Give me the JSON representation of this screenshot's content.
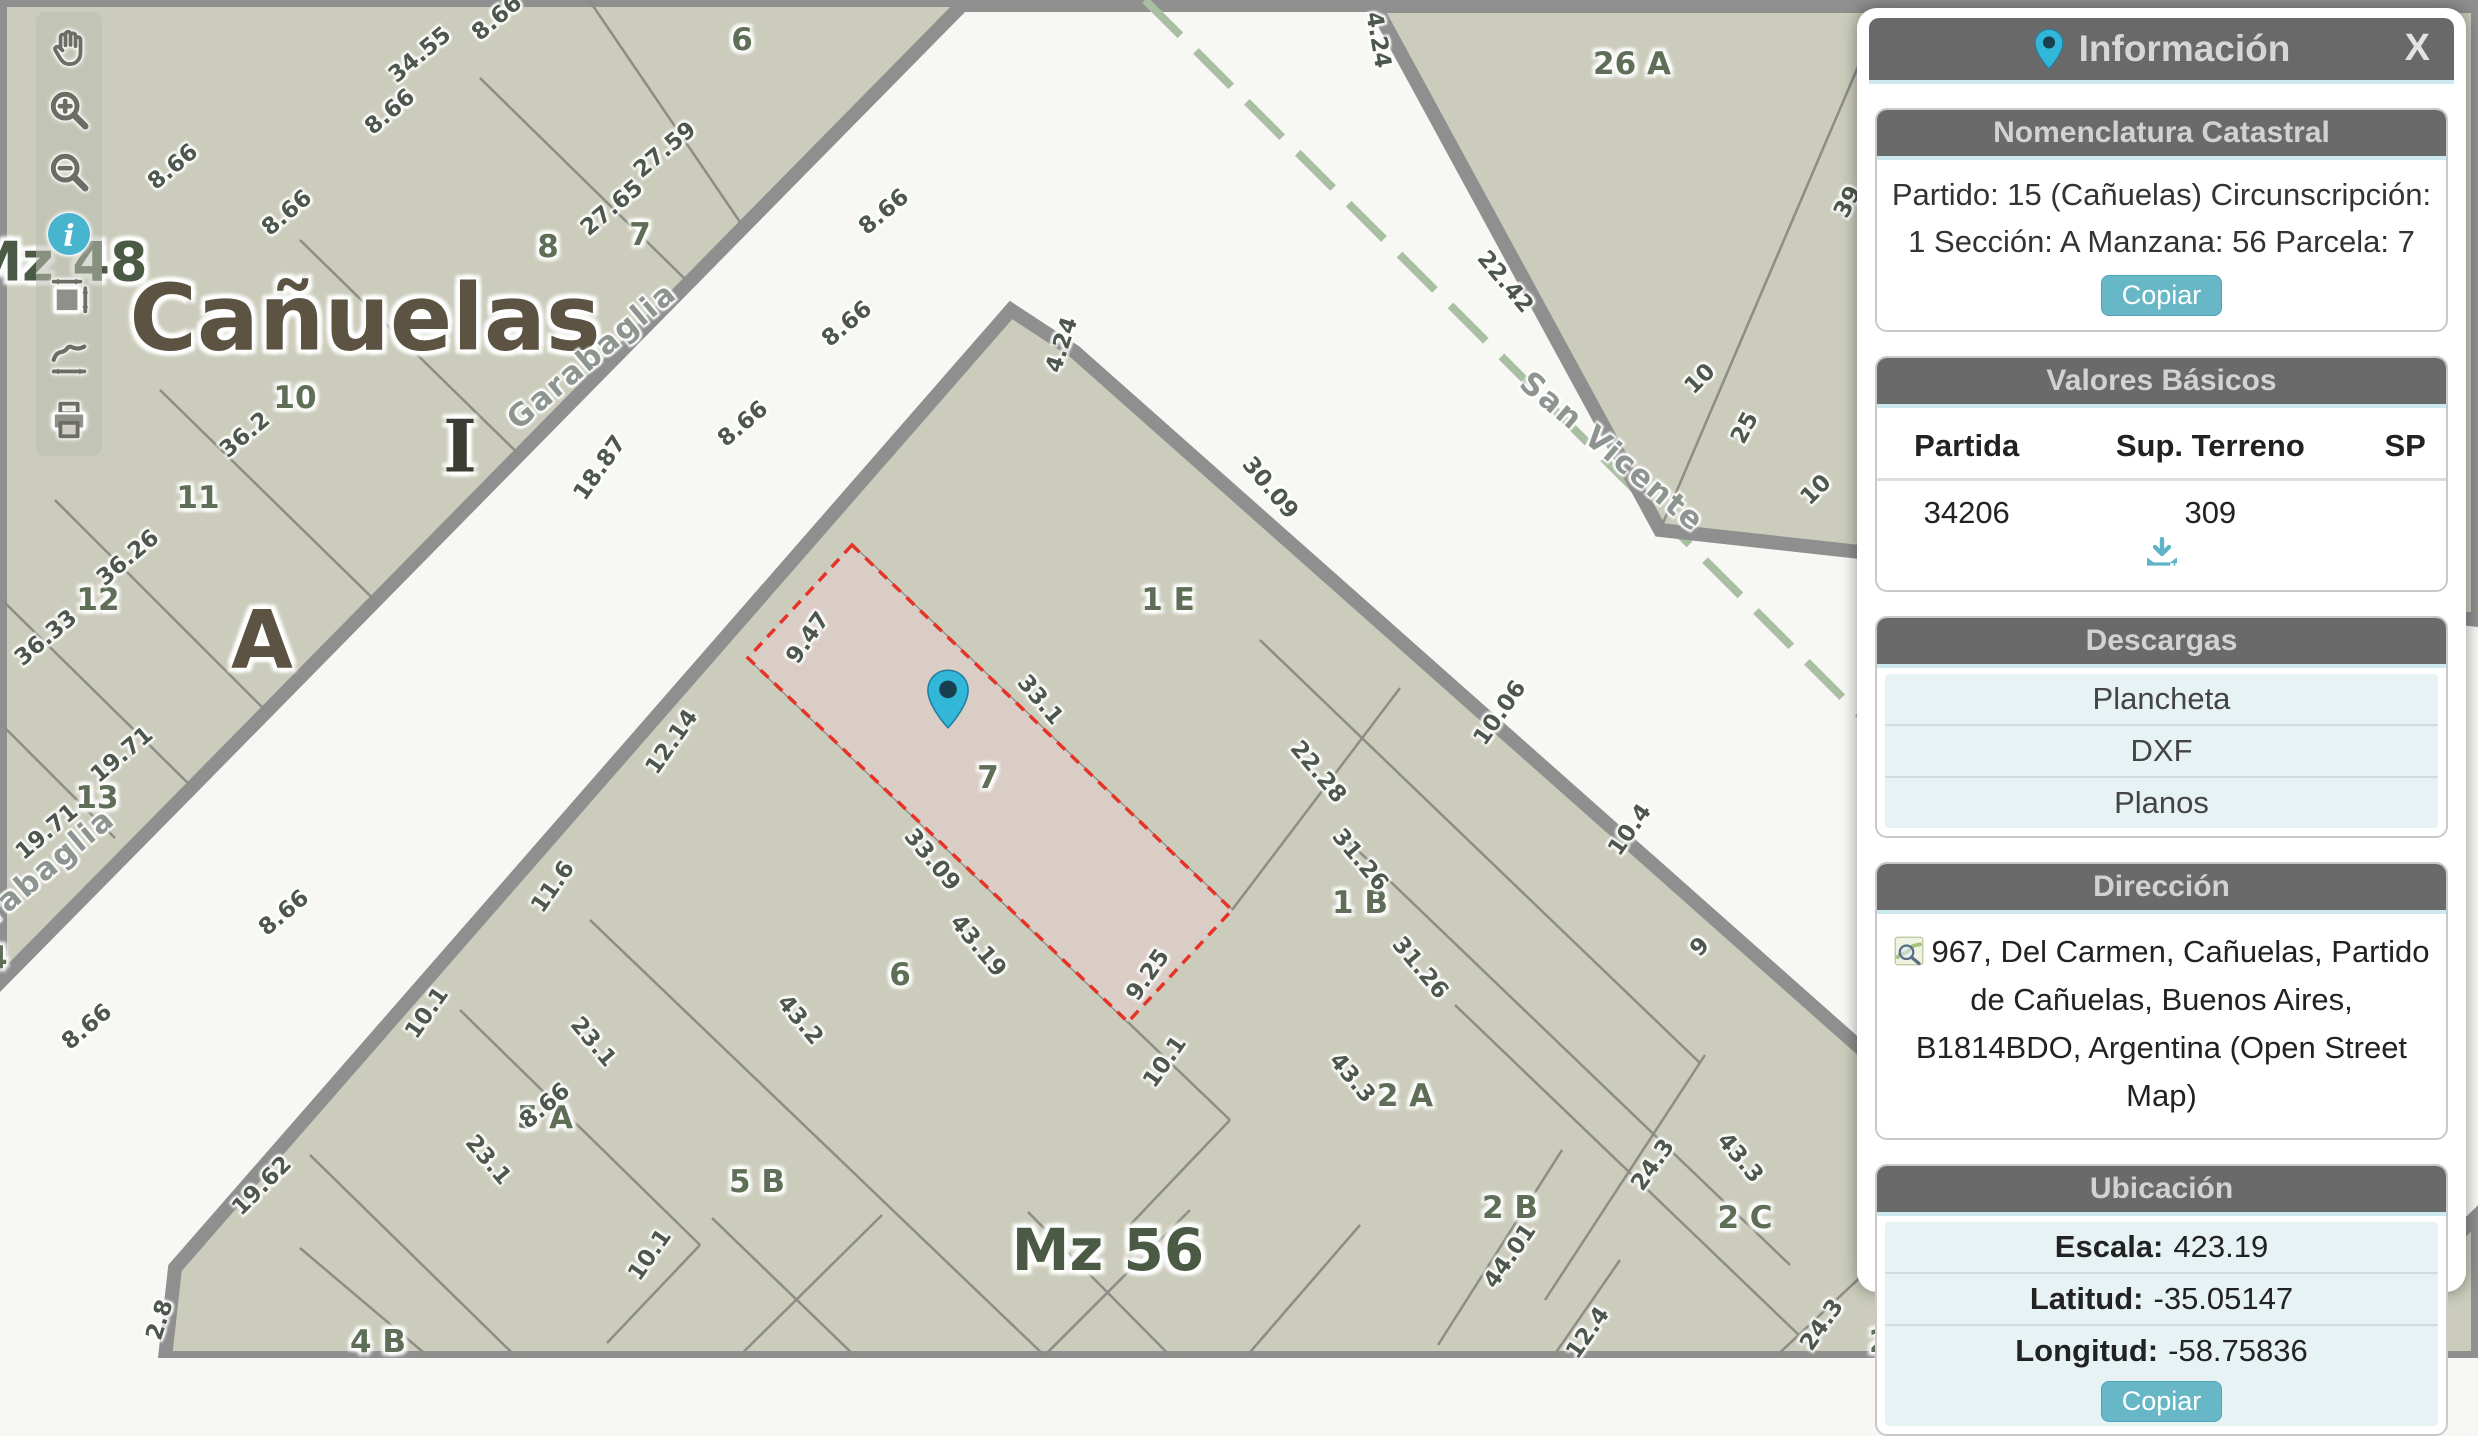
{
  "panel": {
    "title": "Información",
    "close_label": "X",
    "accent_color": "#67b7c7",
    "header_color": "#6a6a6a",
    "sections": {
      "nomenclatura": {
        "title": "Nomenclatura Catastral",
        "text": "Partido: 15 (Cañuelas) Circunscripción: 1 Sección: A Manzana: 56 Parcela: 7",
        "copy_label": "Copiar"
      },
      "valores": {
        "title": "Valores Básicos",
        "headers": [
          "Partida",
          "Sup. Terreno",
          "SP"
        ],
        "row": [
          "34206",
          "309",
          ""
        ],
        "download_icon": "download-tray-icon"
      },
      "descargas": {
        "title": "Descargas",
        "items": [
          "Plancheta",
          "DXF",
          "Planos"
        ]
      },
      "direccion": {
        "title": "Dirección",
        "icon": "osm-map-icon",
        "text": "967, Del Carmen, Cañuelas, Partido de Cañuelas, Buenos Aires, B1814BDO, Argentina (Open Street Map)"
      },
      "ubicacion": {
        "title": "Ubicación",
        "rows": [
          {
            "label": "Escala:",
            "value": "423.19"
          },
          {
            "label": "Latitud:",
            "value": "-35.05147"
          },
          {
            "label": "Longitud:",
            "value": "-58.75836"
          }
        ],
        "copy_label": "Copiar"
      }
    }
  },
  "toolbar": {
    "tools": [
      "pan-hand-icon",
      "zoom-in-icon",
      "zoom-out-icon",
      "info-icon",
      "measure-area-icon",
      "measure-path-icon",
      "print-icon"
    ],
    "active_tool": "info-icon",
    "active_color": "#49b4ce"
  },
  "map": {
    "marker_color": "#33b7d9",
    "highlight_border": "#e63327",
    "highlight_fill": "#d9cdc6",
    "block_fill": "#cbccbb",
    "street_fill": "#f7f7f4",
    "labels": [
      {
        "type": "big",
        "text": "Cañuelas",
        "x": 365,
        "y": 318,
        "rot": 0,
        "size": 92
      },
      {
        "type": "big",
        "text": "A",
        "x": 262,
        "y": 640,
        "rot": 0,
        "size": 80
      },
      {
        "type": "big",
        "text": "I",
        "x": 460,
        "y": 446,
        "rot": 0,
        "size": 72,
        "color": "#3c3c34",
        "serif": true
      },
      {
        "type": "big",
        "text": "Mz 48",
        "x": 58,
        "y": 262,
        "rot": 0,
        "size": 54,
        "color": "#4a5a44"
      },
      {
        "type": "big",
        "text": "Mz 56",
        "x": 1108,
        "y": 1250,
        "rot": 0,
        "size": 58,
        "color": "#4a5a44"
      },
      {
        "type": "street",
        "text": "Garabaglia",
        "x": 592,
        "y": 356,
        "rot": -40
      },
      {
        "type": "street",
        "text": "Garabaglia",
        "x": 30,
        "y": 882,
        "rot": -40
      },
      {
        "type": "street",
        "text": "San Vicente",
        "x": 1612,
        "y": 452,
        "rot": 40
      },
      {
        "type": "parcel",
        "text": "6",
        "x": 742,
        "y": 40,
        "rot": 0
      },
      {
        "type": "parcel",
        "text": "7",
        "x": 640,
        "y": 235,
        "rot": 0
      },
      {
        "type": "parcel",
        "text": "8",
        "x": 548,
        "y": 247,
        "rot": 0
      },
      {
        "type": "parcel",
        "text": "10",
        "x": 295,
        "y": 398,
        "rot": 0
      },
      {
        "type": "parcel",
        "text": "11",
        "x": 198,
        "y": 498,
        "rot": 0
      },
      {
        "type": "parcel",
        "text": "12",
        "x": 98,
        "y": 600,
        "rot": 0
      },
      {
        "type": "parcel",
        "text": "13",
        "x": 97,
        "y": 798,
        "rot": 0
      },
      {
        "type": "parcel",
        "text": "14",
        "x": -14,
        "y": 958,
        "rot": 0
      },
      {
        "type": "parcel",
        "text": "26 A",
        "x": 1632,
        "y": 64,
        "rot": 0
      },
      {
        "type": "parcel",
        "text": "1 E",
        "x": 1168,
        "y": 600,
        "rot": 0
      },
      {
        "type": "parcel",
        "text": "7",
        "x": 988,
        "y": 778,
        "rot": 0
      },
      {
        "type": "parcel",
        "text": "6",
        "x": 900,
        "y": 975,
        "rot": 0
      },
      {
        "type": "parcel",
        "text": "1 B",
        "x": 1360,
        "y": 903,
        "rot": 0
      },
      {
        "type": "parcel",
        "text": "2 A",
        "x": 1405,
        "y": 1096,
        "rot": 0
      },
      {
        "type": "parcel",
        "text": "2 B",
        "x": 1510,
        "y": 1208,
        "rot": 0
      },
      {
        "type": "parcel",
        "text": "2 C",
        "x": 1745,
        "y": 1218,
        "rot": 0
      },
      {
        "type": "parcel",
        "text": "2 D",
        "x": 1898,
        "y": 1342,
        "rot": 0
      },
      {
        "type": "parcel",
        "text": "5 A",
        "x": 545,
        "y": 1118,
        "rot": 0
      },
      {
        "type": "parcel",
        "text": "5 B",
        "x": 757,
        "y": 1182,
        "rot": 0
      },
      {
        "type": "parcel",
        "text": "4 B",
        "x": 378,
        "y": 1342,
        "rot": 0
      },
      {
        "type": "measure",
        "text": "34.55",
        "x": 420,
        "y": 55,
        "rot": -40
      },
      {
        "type": "measure",
        "text": "8.66",
        "x": 497,
        "y": 18,
        "rot": -40
      },
      {
        "type": "measure",
        "text": "8.66",
        "x": 390,
        "y": 112,
        "rot": -40
      },
      {
        "type": "measure",
        "text": "8.66",
        "x": 173,
        "y": 167,
        "rot": -40
      },
      {
        "type": "measure",
        "text": "8.66",
        "x": 287,
        "y": 213,
        "rot": -40
      },
      {
        "type": "measure",
        "text": "27.59",
        "x": 665,
        "y": 150,
        "rot": -40
      },
      {
        "type": "measure",
        "text": "27.65",
        "x": 612,
        "y": 208,
        "rot": -40
      },
      {
        "type": "measure",
        "text": "8.66",
        "x": 884,
        "y": 212,
        "rot": -40
      },
      {
        "type": "measure",
        "text": "8.66",
        "x": 847,
        "y": 324,
        "rot": -40
      },
      {
        "type": "measure",
        "text": "8.66",
        "x": 743,
        "y": 424,
        "rot": -40
      },
      {
        "type": "measure",
        "text": "8.66",
        "x": 284,
        "y": 913,
        "rot": -40
      },
      {
        "type": "measure",
        "text": "8.66",
        "x": 87,
        "y": 1027,
        "rot": -40
      },
      {
        "type": "measure",
        "text": "8.66",
        "x": 545,
        "y": 1106,
        "rot": -40
      },
      {
        "type": "measure",
        "text": "36.2",
        "x": 245,
        "y": 435,
        "rot": -40
      },
      {
        "type": "measure",
        "text": "36.26",
        "x": 128,
        "y": 558,
        "rot": -40
      },
      {
        "type": "measure",
        "text": "36.33",
        "x": 46,
        "y": 638,
        "rot": -40
      },
      {
        "type": "measure",
        "text": "19.71",
        "x": 122,
        "y": 755,
        "rot": -40
      },
      {
        "type": "measure",
        "text": "19.71",
        "x": 47,
        "y": 832,
        "rot": -40
      },
      {
        "type": "measure",
        "text": "4.24",
        "x": 1378,
        "y": 40,
        "rot": 80
      },
      {
        "type": "measure",
        "text": "22.42",
        "x": 1505,
        "y": 282,
        "rot": 50
      },
      {
        "type": "measure",
        "text": "25",
        "x": 1745,
        "y": 428,
        "rot": -62
      },
      {
        "type": "measure",
        "text": "39",
        "x": 1848,
        "y": 202,
        "rot": -62
      },
      {
        "type": "measure",
        "text": "10",
        "x": 1700,
        "y": 379,
        "rot": -45
      },
      {
        "type": "measure",
        "text": "10",
        "x": 1816,
        "y": 490,
        "rot": -45
      },
      {
        "type": "measure",
        "text": "4.24",
        "x": 1062,
        "y": 345,
        "rot": -72
      },
      {
        "type": "measure",
        "text": "18.87",
        "x": 600,
        "y": 468,
        "rot": -55
      },
      {
        "type": "measure",
        "text": "30.09",
        "x": 1270,
        "y": 488,
        "rot": 50
      },
      {
        "type": "measure",
        "text": "9.47",
        "x": 808,
        "y": 638,
        "rot": -55
      },
      {
        "type": "measure",
        "text": "33.1",
        "x": 1040,
        "y": 700,
        "rot": 50
      },
      {
        "type": "measure",
        "text": "12.14",
        "x": 672,
        "y": 742,
        "rot": -55
      },
      {
        "type": "measure",
        "text": "33.09",
        "x": 932,
        "y": 860,
        "rot": 50
      },
      {
        "type": "measure",
        "text": "43.19",
        "x": 978,
        "y": 946,
        "rot": 50
      },
      {
        "type": "measure",
        "text": "22.28",
        "x": 1318,
        "y": 772,
        "rot": 50
      },
      {
        "type": "measure",
        "text": "31.26",
        "x": 1360,
        "y": 860,
        "rot": 50
      },
      {
        "type": "measure",
        "text": "10.06",
        "x": 1500,
        "y": 713,
        "rot": -55
      },
      {
        "type": "measure",
        "text": "10.4",
        "x": 1630,
        "y": 830,
        "rot": -55
      },
      {
        "type": "measure",
        "text": "9",
        "x": 1700,
        "y": 947,
        "rot": -45
      },
      {
        "type": "measure",
        "text": "11.6",
        "x": 553,
        "y": 887,
        "rot": -55
      },
      {
        "type": "measure",
        "text": "10.1",
        "x": 427,
        "y": 1013,
        "rot": -55
      },
      {
        "type": "measure",
        "text": "43.2",
        "x": 800,
        "y": 1020,
        "rot": 50
      },
      {
        "type": "measure",
        "text": "23.1",
        "x": 593,
        "y": 1042,
        "rot": 50
      },
      {
        "type": "measure",
        "text": "23.1",
        "x": 488,
        "y": 1160,
        "rot": 50
      },
      {
        "type": "measure",
        "text": "10.1",
        "x": 650,
        "y": 1255,
        "rot": -55
      },
      {
        "type": "measure",
        "text": "9.25",
        "x": 1148,
        "y": 975,
        "rot": -55
      },
      {
        "type": "measure",
        "text": "10.1",
        "x": 1165,
        "y": 1062,
        "rot": -55
      },
      {
        "type": "measure",
        "text": "31.26",
        "x": 1420,
        "y": 968,
        "rot": 50
      },
      {
        "type": "measure",
        "text": "43.3",
        "x": 1352,
        "y": 1078,
        "rot": 50
      },
      {
        "type": "measure",
        "text": "43.3",
        "x": 1740,
        "y": 1158,
        "rot": 50
      },
      {
        "type": "measure",
        "text": "19.62",
        "x": 262,
        "y": 1186,
        "rot": -45
      },
      {
        "type": "measure",
        "text": "2.8",
        "x": 160,
        "y": 1320,
        "rot": -72
      },
      {
        "type": "measure",
        "text": "44.01",
        "x": 1510,
        "y": 1256,
        "rot": -55
      },
      {
        "type": "measure",
        "text": "24.3",
        "x": 1653,
        "y": 1165,
        "rot": -55
      },
      {
        "type": "measure",
        "text": "24.3",
        "x": 1822,
        "y": 1325,
        "rot": -55
      },
      {
        "type": "measure",
        "text": "12.4",
        "x": 1588,
        "y": 1333,
        "rot": -55
      }
    ]
  }
}
